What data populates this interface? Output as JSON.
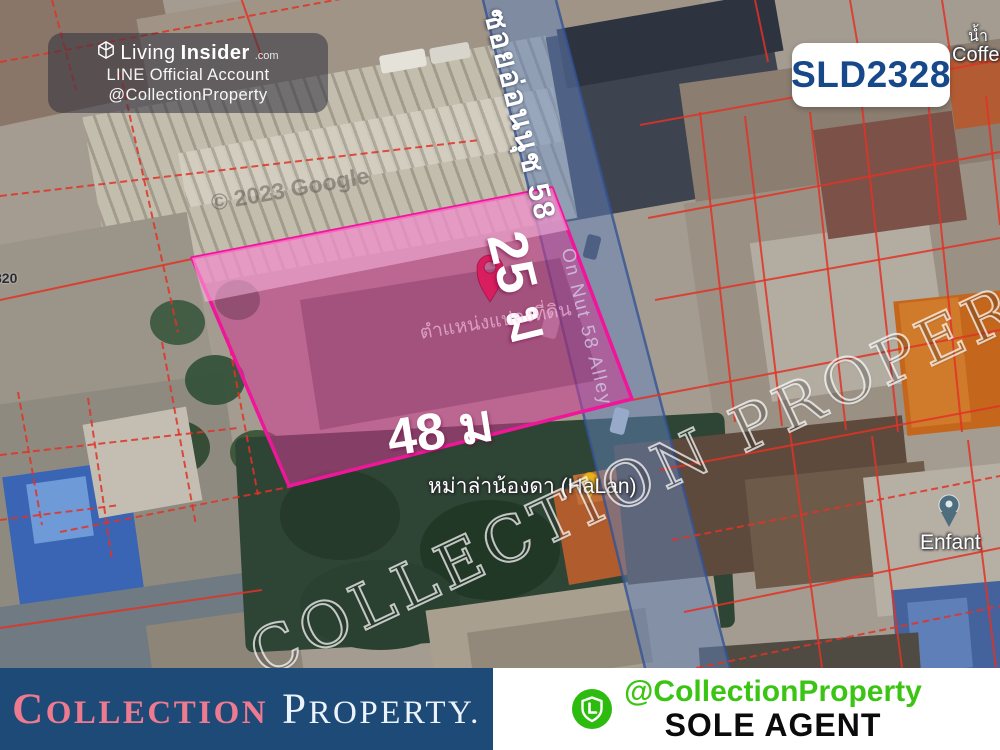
{
  "listing_code": "SLD2328",
  "overlay_badge": {
    "brand_light": "Living",
    "brand_bold": "Insider",
    "brand_tld": ".com",
    "line1": "LINE Official Account",
    "line2": "@CollectionProperty"
  },
  "map": {
    "street_name_thai": "ซอยอ่อนนุช 58",
    "street_name_en": "On Nut 58 Alley",
    "plot": {
      "frontage_label": "48 ม",
      "depth_label": "25 ม",
      "caption": "ตำแหน่งแปลงที่ดิน"
    },
    "poi": {
      "halan": "หม่าล่าน้องดา (HaLan)",
      "enfant": "Enfant",
      "coffee": "Coffee",
      "coffee_upper": "น้ำ",
      "left_fragment": "820"
    },
    "attribution": "© 2023 Google",
    "watermark": "COLLECTION PROPERTY."
  },
  "footer": {
    "brand_word1": "Collection",
    "brand_word2": "Property.",
    "line_handle": "@CollectionProperty",
    "sole_agent": "SOLE AGENT"
  },
  "colors": {
    "plot_fill": "#cd3c91",
    "plot_border": "#f0169a",
    "pin": "#d81e5e",
    "road_overlay": "#6082bc",
    "cadastral_line": "#e03326",
    "footer_blue": "#1d4a77",
    "brand_pink": "#ee7a90",
    "code_navy": "#17498a",
    "line_green": "#2cbb0e"
  }
}
